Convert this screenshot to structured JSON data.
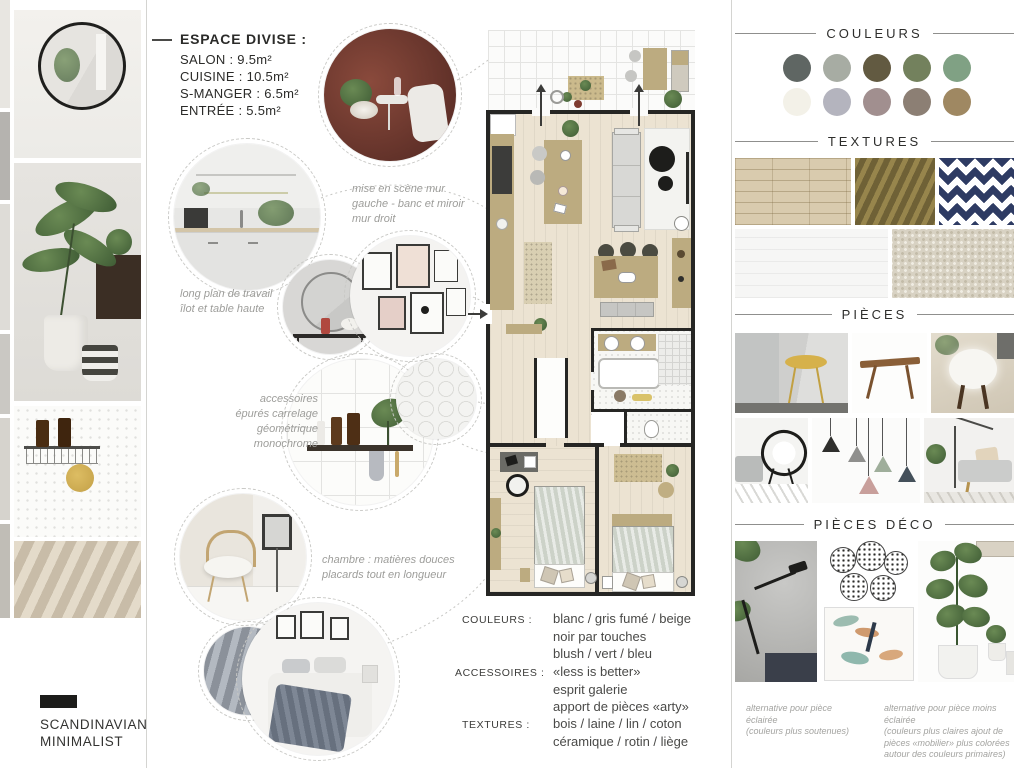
{
  "logo": {
    "lines": [
      "SCANDINAVIAN",
      "MINIMALIST"
    ]
  },
  "header": {
    "title": "ESPACE DIVISE :",
    "items": [
      "SALON : 9.5m²",
      "CUISINE : 10.5m²",
      "S-MANGER : 6.5m²",
      "ENTRÉE : 5.5m²"
    ]
  },
  "annotations": {
    "mise": {
      "lines": [
        "mise en scène mur",
        "gauche - banc et miroir",
        "mur droit"
      ]
    },
    "plan_travail": {
      "lines": [
        "long plan de travail",
        "îlot et table haute"
      ]
    },
    "accessoires": {
      "lines": [
        "accessoires",
        "épurés carrelage",
        "géométrique",
        "monochrome"
      ]
    },
    "chambre": {
      "lines": [
        "chambre : matières douces",
        "placards tout en longueur"
      ]
    }
  },
  "specs": {
    "rows": [
      {
        "label": "COULEURS :",
        "lines": [
          "blanc / gris fumé / beige",
          "noir par touches",
          "blush / vert / bleu"
        ]
      },
      {
        "label": "ACCESSOIRES :",
        "lines": [
          "«less is better»",
          "esprit galerie",
          "apport de pièces «arty»"
        ]
      },
      {
        "label": "TEXTURES :",
        "lines": [
          "bois / laine / lin / coton",
          "céramique / rotin / liège"
        ]
      }
    ]
  },
  "right": {
    "sections": {
      "couleurs": "COULEURS",
      "textures": "TEXTURES",
      "pieces": "PIÈCES",
      "pieces_deco": "PIÈCES DÉCO"
    },
    "palette": {
      "row1": [
        "#5f6663",
        "#a7aca3",
        "#625a41",
        "#73815d",
        "#80a184"
      ],
      "row2": [
        "#f3f1e8",
        "#b4b4be",
        "#a18f8f",
        "#8c7f74",
        "#9f8862"
      ]
    },
    "captions": [
      {
        "lines": [
          "alternative pour pièce éclairée",
          "(couleurs plus soutenues)"
        ]
      },
      {
        "lines": [
          "alternative pour pièce moins",
          "éclairée",
          "(couleurs plus claires ajout de",
          "pièces «mobilier» plus colorées",
          "autour des couleurs primaires)"
        ]
      }
    ]
  }
}
